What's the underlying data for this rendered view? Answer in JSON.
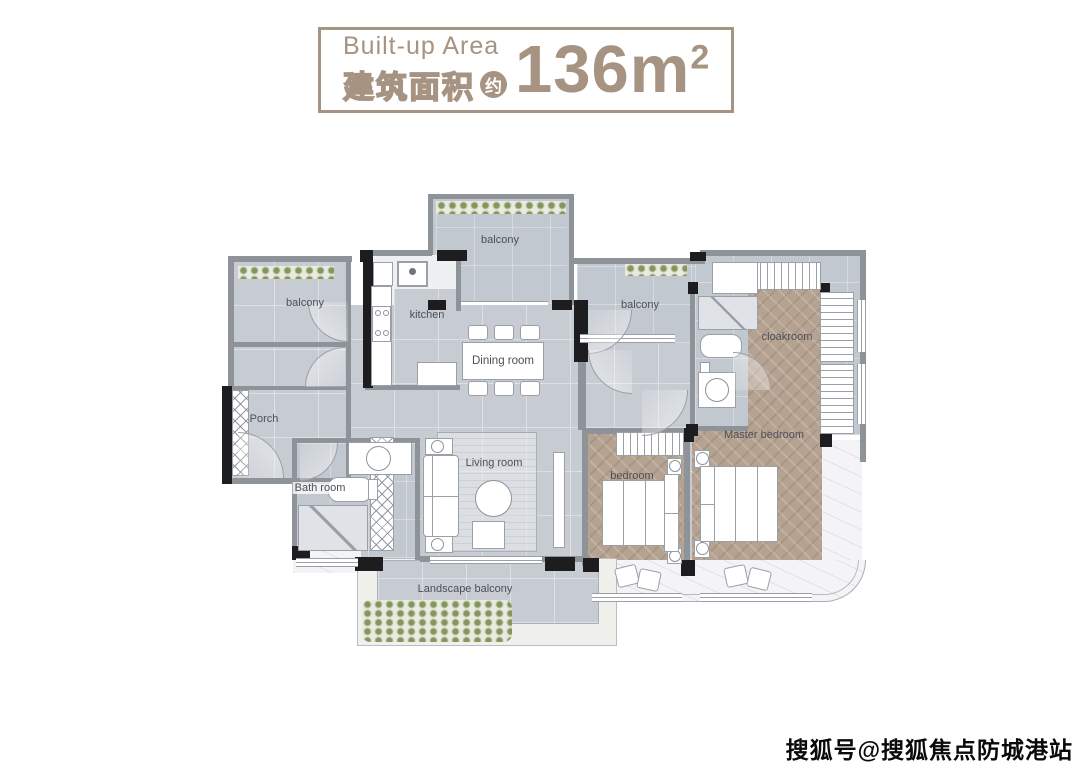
{
  "header": {
    "title_en": "Built-up Area",
    "title_cn": "建筑面积",
    "approx_badge": "约",
    "area_value": "136m",
    "area_superscript": "2",
    "accent_color": "#a69381"
  },
  "floor_plan": {
    "rooms": [
      {
        "id": "balcony-top",
        "label": "balcony"
      },
      {
        "id": "balcony-left",
        "label": "balcony"
      },
      {
        "id": "kitchen",
        "label": "kitchen"
      },
      {
        "id": "dining-room",
        "label": "Dining room"
      },
      {
        "id": "balcony-right",
        "label": "balcony"
      },
      {
        "id": "cloakroom",
        "label": "cloakroom"
      },
      {
        "id": "porch",
        "label": "Porch"
      },
      {
        "id": "bath-room",
        "label": "Bath room"
      },
      {
        "id": "living-room",
        "label": "Living room"
      },
      {
        "id": "bedroom",
        "label": "bedroom"
      },
      {
        "id": "master-bedroom",
        "label": "Master bedroom"
      },
      {
        "id": "landscape-balcony",
        "label": "Landscape balcony"
      }
    ],
    "colors": {
      "floor_gray": "#c7ccd3",
      "floor_wood": "#b5a291",
      "wall_dark": "#1d1d1f",
      "wall_gray": "#8d9399",
      "marble": "#f4f4f6",
      "greenery": "#84955d"
    }
  },
  "watermark": {
    "text": "搜狐号@搜狐焦点防城港站"
  }
}
